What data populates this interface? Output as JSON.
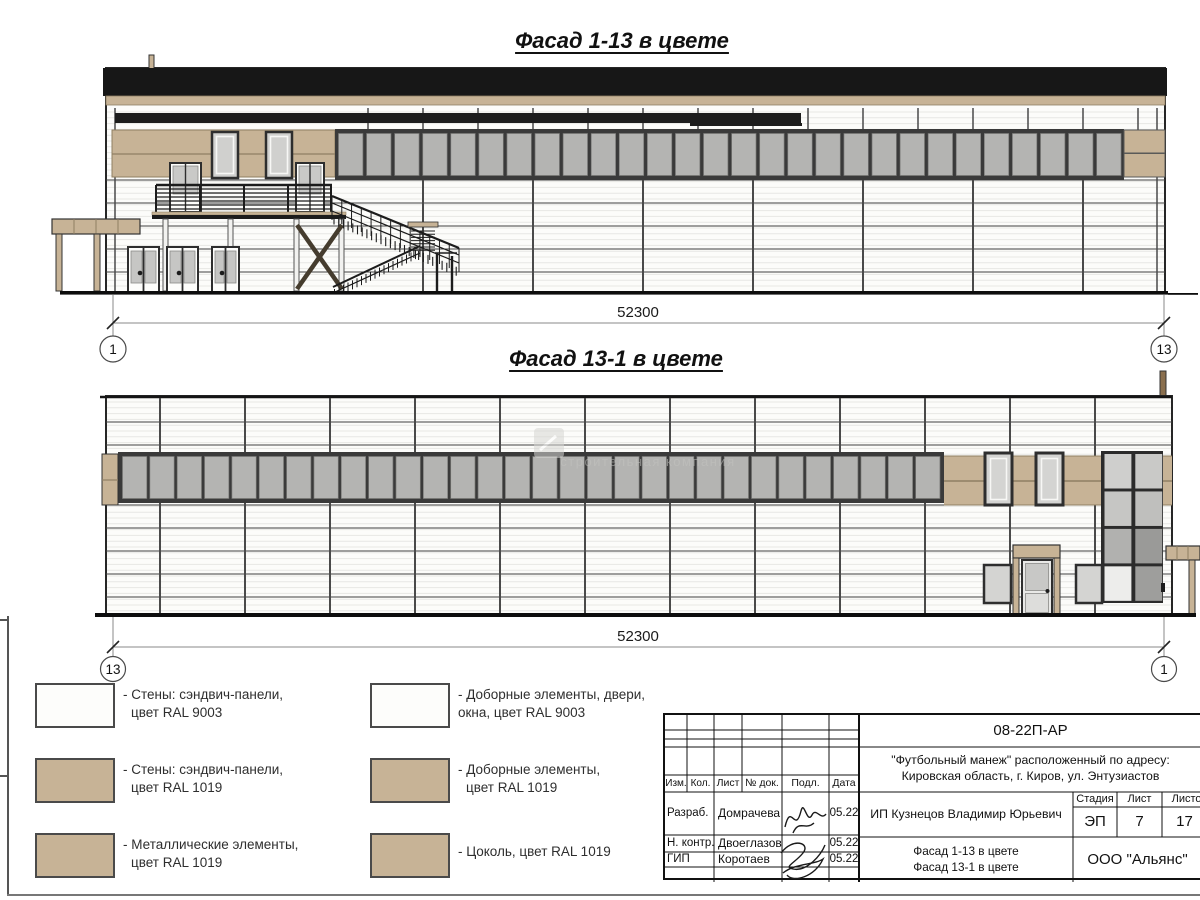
{
  "titles": {
    "facade1": "Фасад 1-13 в цвете",
    "facade2": "Фасад 13-1 в цвете"
  },
  "dimensions": {
    "facade1_length": "52300",
    "facade2_length": "52300"
  },
  "axis_markers": {
    "f1_left": "1",
    "f1_right": "13",
    "f2_left": "13",
    "f2_right": "1"
  },
  "watermark": {
    "text": "строительная компания"
  },
  "colors": {
    "ral9003": "#fdfdfb",
    "ral1019": "#c7b396",
    "metal_black": "#171717",
    "window_glass": "#b4b4b2",
    "window_frame": "#3a3a3a"
  },
  "legend": {
    "items": [
      {
        "color_key": "ral9003",
        "line1": "- Стены: сэндвич-панели,",
        "line2": "цвет RAL 9003"
      },
      {
        "color_key": "ral1019",
        "line1": "- Стены: сэндвич-панели,",
        "line2": "цвет RAL 1019"
      },
      {
        "color_key": "ral1019",
        "line1": "- Металлические элементы,",
        "line2": "цвет RAL 1019"
      },
      {
        "color_key": "ral9003",
        "line1": "- Доборные элементы, двери,",
        "line2": "окна, цвет RAL 9003"
      },
      {
        "color_key": "ral1019",
        "line1": "- Доборные элементы,",
        "line2": "цвет RAL 1019"
      },
      {
        "color_key": "ral1019",
        "line1": "- Цоколь, цвет RAL 1019",
        "line2": ""
      }
    ]
  },
  "title_block": {
    "doc_number": "08-22П-АР",
    "project_line1": "\"Футбольный манеж\" расположенный по адресу:",
    "project_line2": "Кировская область, г. Киров, ул. Энтузиастов",
    "client": "ИП Кузнецов Владимир Юрьевич",
    "columns": {
      "izm": "Изм.",
      "kol": "Кол.",
      "list": "Лист",
      "doc": "№ док.",
      "podp": "Подл.",
      "data": "Дата"
    },
    "rows": [
      {
        "role": "Разраб.",
        "name": "Домрачева",
        "date": "05.22"
      },
      {
        "role": "Н. контр.",
        "name": "Двоеглазов",
        "date": "05.22"
      },
      {
        "role": "ГИП",
        "name": "Коротаев",
        "date": "05.22"
      }
    ],
    "stage_label": "Стадия",
    "sheet_label": "Лист",
    "sheets_label": "Листов",
    "stage_value": "ЭП",
    "sheet_value": "7",
    "sheets_value": "17",
    "sheet_name_line1": "Фасад 1-13 в цвете",
    "sheet_name_line2": "Фасад 13-1 в цвете",
    "company": "ООО \"Альянс\""
  }
}
